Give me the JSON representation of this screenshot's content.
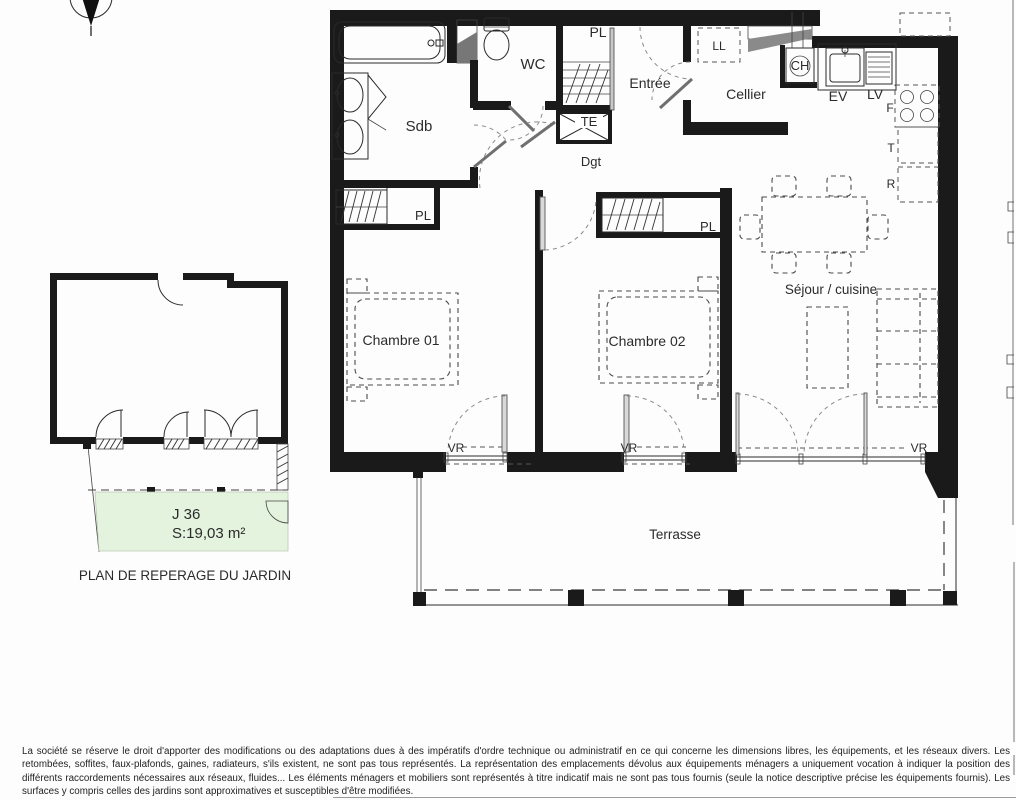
{
  "plan_labels": {
    "sdb": "Sdb",
    "wc": "WC",
    "pl": "PL",
    "te": "TE",
    "entree": "Entrée",
    "cellier": "Cellier",
    "ll": "LL",
    "ch": "CH",
    "ev": "EV",
    "lv": "LV",
    "four": "F",
    "t": "T",
    "r": "R",
    "dgt": "Dgt",
    "chambre1": "Chambre 01",
    "chambre2": "Chambre 02",
    "sejour": "Séjour / cuisine",
    "vr": "VR",
    "terrasse": "Terrasse"
  },
  "garden": {
    "lot": "J 36",
    "area": "S:19,03 m²",
    "caption": "PLAN DE REPERAGE DU JARDIN",
    "fill": "#e4f3de"
  },
  "disclaimer": "La société se réserve le droit d'apporter des modifications ou des adaptations dues à des impératifs d'ordre technique ou administratif en ce qui concerne les dimensions libres, les équipements, et les réseaux divers. Les retombées, soffites, faux-plafonds, gaines, radiateurs, s'ils existent, ne sont pas tous représentés. La représentation des emplacements dévolus aux équipements ménagers a uniquement vocation à indiquer la position des différents raccordements nécessaires aux réseaux, fluides... Les éléments ménagers et mobiliers sont représentés à titre indicatif mais ne sont pas tous fournis (seule la notice descriptive précise les équipements fournis). Les surfaces y compris celles des jardins sont approximatives et susceptibles d'être modifiées.",
  "colors": {
    "ink": "#1a1a1a",
    "line": "#2a2a2a",
    "dash_gray": "#555555",
    "garden_green": "#e4f3de"
  }
}
